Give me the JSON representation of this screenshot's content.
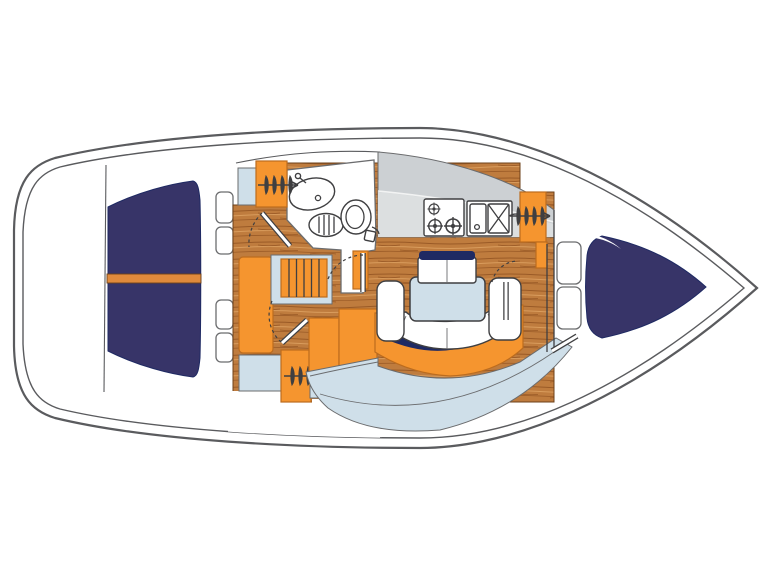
{
  "diagram": {
    "kind": "sailboat-interior-floor-plan",
    "view": "top-down",
    "bow_direction": "right",
    "areas": [
      "stern-platform",
      "aft-double-cabin-berth",
      "side-shelf-lockers",
      "hanging-lockers",
      "companionway-steps",
      "head-with-washbasin-shower-and-toilet",
      "nav-station",
      "galley-with-stove-and-sink",
      "salon-dinette-with-folding-table",
      "v-berth-forward-cabin"
    ],
    "icons": {
      "hanger_rail": "clothes-hanger-rail-icon",
      "stove": "three-burner-stove-icon",
      "galley_sink": "double-galley-sink-icon",
      "washbasin": "oval-washbasin-icon",
      "toilet": "marine-toilet-icon",
      "shower_drain": "shower-drain-icon",
      "steps": "companionway-steps-icon",
      "door_swing": "dashed-door-swing-arc"
    }
  },
  "colors": {
    "background": "#ffffff",
    "hull_outline": "#5a5b5e",
    "berth_navy": "#373468",
    "trim_navy": "#1f2a63",
    "accent_orange": "#f5952f",
    "orange_outline": "#bc6c1e",
    "berth_stripe_orange": "#e08a3c",
    "wood_base": "#bf7c3e",
    "wood_grain_dark": "#9a5a26",
    "wood_grain_light": "#d99c5c",
    "wood_edge": "#6e4119",
    "upholstery_blue": "#cfdfe9",
    "counter_gray": "#ccd0d3",
    "counter_light": "#dcdfe0",
    "line_dark": "#3f3f41",
    "line_mid": "#6b6c6e"
  }
}
